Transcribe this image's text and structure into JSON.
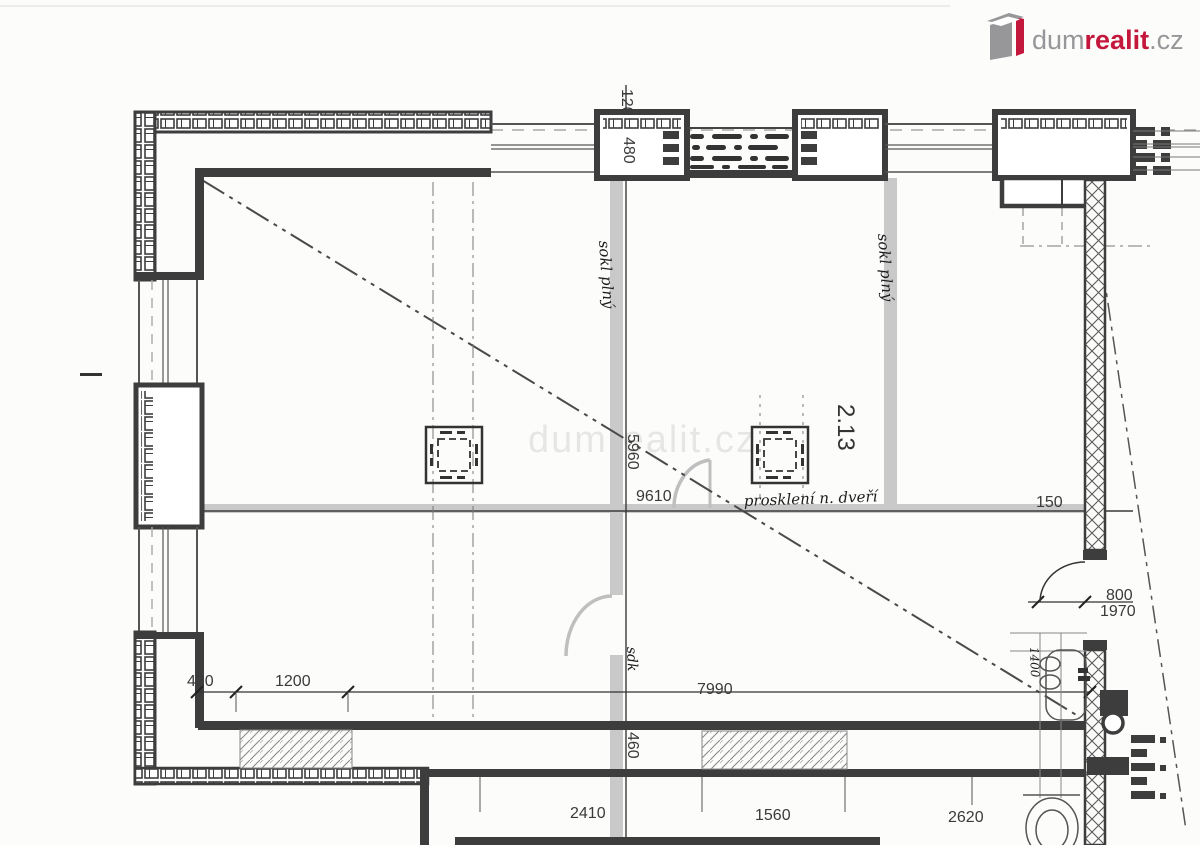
{
  "brand": {
    "name_gray": "dum",
    "name_accent": "realit",
    "name_tld": ".cz",
    "accent_color": "#c4173c",
    "gray_color": "#97979a"
  },
  "watermark": "dumrealit.cz",
  "room_label": "2.13",
  "dims": {
    "d120": "120",
    "d480": "480",
    "d5960": "5960",
    "d9610": "9610",
    "d150": "150",
    "d800": "800",
    "d1970": "1970",
    "d420": "420",
    "d1200": "1200",
    "d7990": "7990",
    "d460": "460",
    "d2410": "2410",
    "d1560": "1560",
    "d2620": "2620",
    "d1400": "1400"
  },
  "notes": {
    "sokl_left": "sokl plný",
    "sokl_right": "sokl plný",
    "glazing": "prosklení n. dveří",
    "sdk": "sdk"
  }
}
